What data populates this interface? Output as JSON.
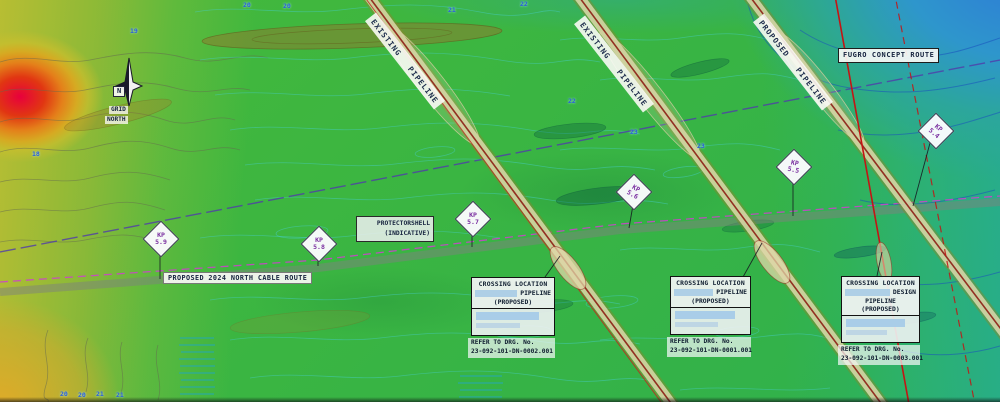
{
  "north": {
    "n": "N",
    "grid": "GRID",
    "north": "NORTH"
  },
  "routes": {
    "cable_label": "PROPOSED 2024 NORTH CABLE ROUTE",
    "fugro_label": "FUGRO CONCEPT ROUTE",
    "protector_line1": "PROTECTORSHELL",
    "protector_line2": "(INDICATIVE)"
  },
  "pipelines": [
    {
      "word1": "EXISTING",
      "word2": "PIPELINE"
    },
    {
      "word1": "EXISTING",
      "word2": "PIPELINE"
    },
    {
      "word1": "PROPOSED",
      "word2": "PIPELINE"
    }
  ],
  "kp_markers": [
    {
      "prefix": "KP",
      "value": "5.9"
    },
    {
      "prefix": "KP",
      "value": "5.8"
    },
    {
      "prefix": "KP",
      "value": "5.7"
    },
    {
      "prefix": "KP",
      "value": "5.6"
    },
    {
      "prefix": "KP",
      "value": "5.5"
    },
    {
      "prefix": "KP",
      "value": "5.4"
    }
  ],
  "crossings": [
    {
      "title": "CROSSING LOCATION",
      "line2": "PIPELINE",
      "line3": "(PROPOSED)",
      "refer": "REFER TO DRG. No.",
      "drg": "23-092-101-DN-0002.001"
    },
    {
      "title": "CROSSING LOCATION",
      "line2": "PIPELINE",
      "line3": "(PROPOSED)",
      "refer": "REFER TO DRG. No.",
      "drg": "23-092-101-DN-0001.001"
    },
    {
      "title": "CROSSING LOCATION",
      "line2": "DESIGN",
      "line3": "PIPELINE (PROPOSED)",
      "refer": "REFER TO DRG. No.",
      "drg": "23-092-101-DN-0003.001"
    }
  ],
  "depths": [
    {
      "value": "19",
      "x": 130,
      "y": 27
    },
    {
      "value": "20",
      "x": 243,
      "y": 1
    },
    {
      "value": "20",
      "x": 283,
      "y": 2
    },
    {
      "value": "21",
      "x": 448,
      "y": 6
    },
    {
      "value": "22",
      "x": 520,
      "y": 0
    },
    {
      "value": "22",
      "x": 568,
      "y": 97
    },
    {
      "value": "23",
      "x": 630,
      "y": 128
    },
    {
      "value": "23",
      "x": 697,
      "y": 142
    },
    {
      "value": "18",
      "x": 32,
      "y": 150
    },
    {
      "value": "20",
      "x": 60,
      "y": 390
    },
    {
      "value": "20",
      "x": 78,
      "y": 391
    },
    {
      "value": "21",
      "x": 96,
      "y": 390
    },
    {
      "value": "21",
      "x": 116,
      "y": 391
    }
  ],
  "colors": {
    "contour_blue": "#2b5fd9",
    "kp_purple": "#7a2fa0",
    "route_magenta": "#cf3fcf",
    "pipeline_red": "#8c1e14",
    "design_red": "#c41414"
  }
}
